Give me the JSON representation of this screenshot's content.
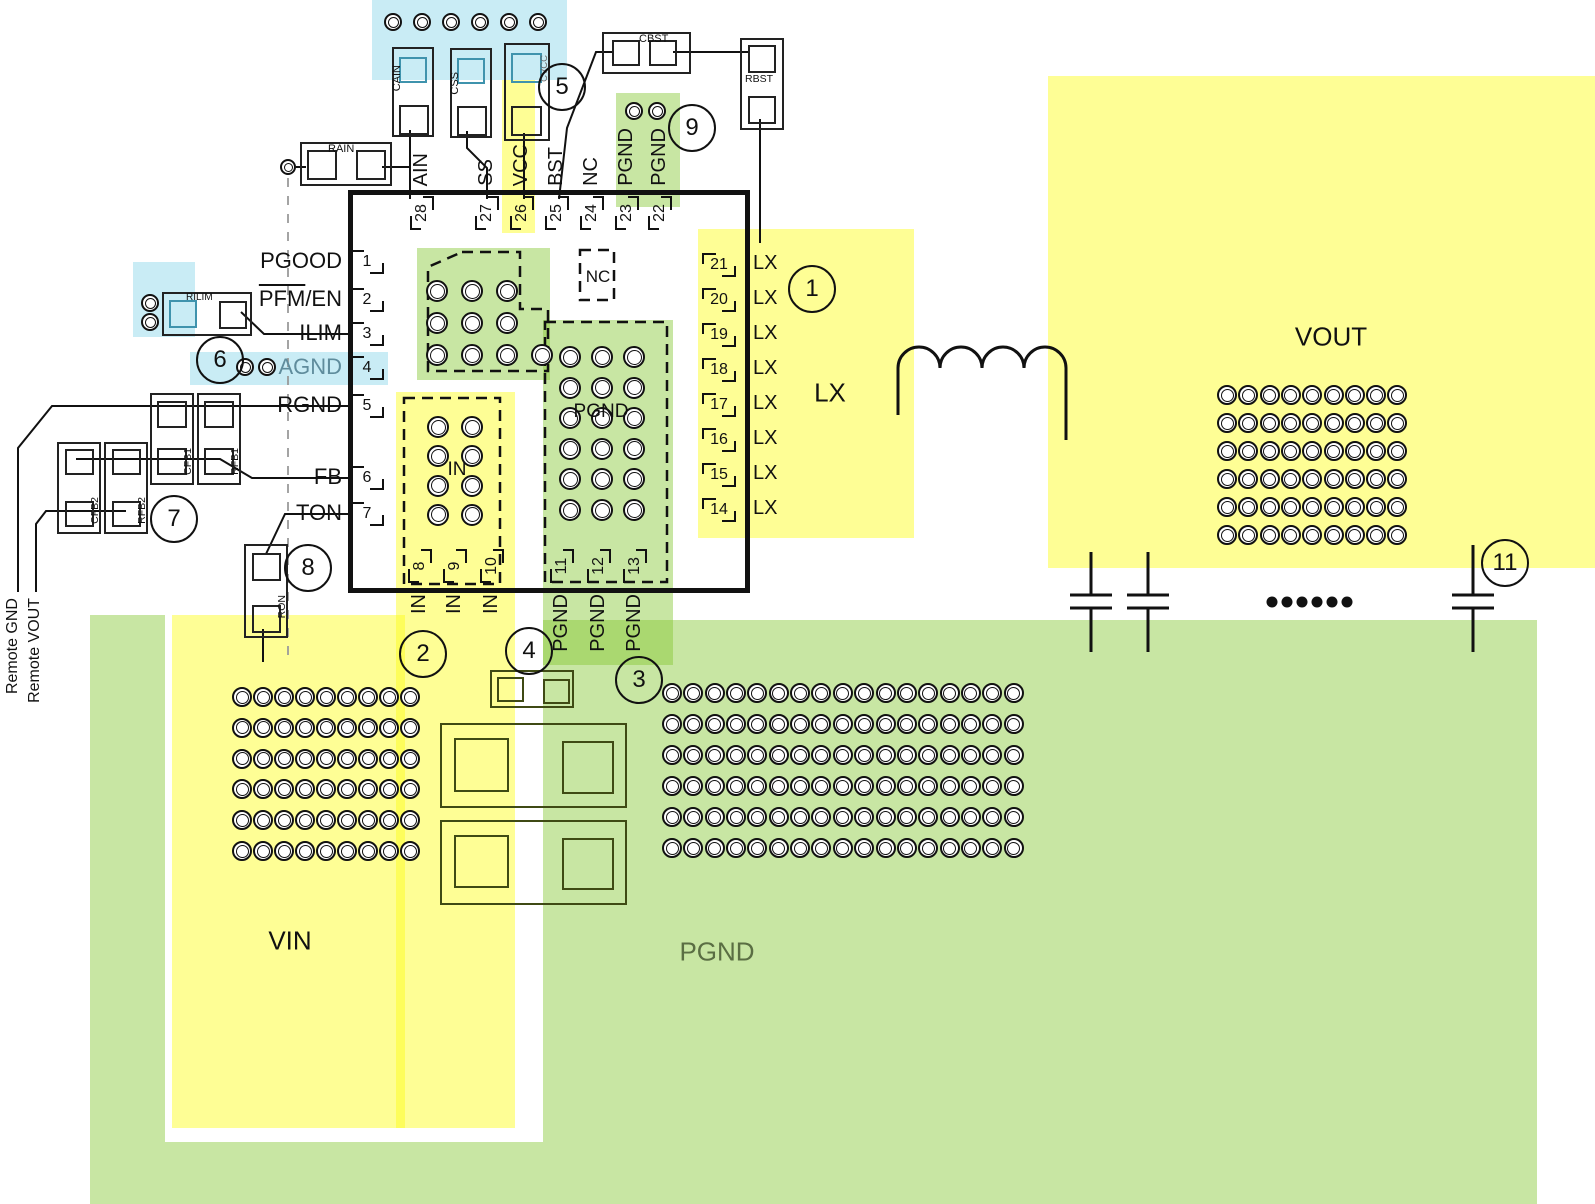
{
  "regions": {
    "vin": "VIN",
    "pgnd_plane": "PGND",
    "vout": "VOUT",
    "lx_area": "LX",
    "in_inner": "IN",
    "pgnd_inner": "PGND",
    "nc_inner": "NC"
  },
  "ic": {
    "pins_left": [
      {
        "num": "1",
        "label": "PGOOD"
      },
      {
        "num": "2",
        "label": "PFM/EN",
        "overline": "PFM"
      },
      {
        "num": "3",
        "label": "ILIM"
      },
      {
        "num": "4",
        "label": "AGND"
      },
      {
        "num": "5",
        "label": "RGND"
      },
      {
        "num": "6",
        "label": "FB"
      },
      {
        "num": "7",
        "label": "TON"
      }
    ],
    "pins_top": [
      {
        "num": "28",
        "label": "AIN"
      },
      {
        "num": "27",
        "label": "SS"
      },
      {
        "num": "26",
        "label": "VCC"
      },
      {
        "num": "25",
        "label": "BST"
      },
      {
        "num": "24",
        "label": "NC"
      },
      {
        "num": "23",
        "label": "PGND"
      },
      {
        "num": "22",
        "label": "PGND"
      }
    ],
    "pins_right": [
      {
        "num": "21",
        "label": "LX"
      },
      {
        "num": "20",
        "label": "LX"
      },
      {
        "num": "19",
        "label": "LX"
      },
      {
        "num": "18",
        "label": "LX"
      },
      {
        "num": "17",
        "label": "LX"
      },
      {
        "num": "16",
        "label": "LX"
      },
      {
        "num": "15",
        "label": "LX"
      },
      {
        "num": "14",
        "label": "LX"
      }
    ],
    "pins_bottom": [
      {
        "num": "8",
        "label": "IN"
      },
      {
        "num": "9",
        "label": "IN"
      },
      {
        "num": "10",
        "label": "IN"
      },
      {
        "num": "11",
        "label": "PGND"
      },
      {
        "num": "12",
        "label": "PGND"
      },
      {
        "num": "13",
        "label": "PGND"
      }
    ]
  },
  "components": {
    "cain": "CAIN",
    "css": "CSS",
    "cvcc": "CVCC",
    "cbst": "CBST",
    "rbst": "RBST",
    "rain": "RAIN",
    "rilim": "RILIM",
    "cfb1": "CFB1",
    "rfb1": "RFB1",
    "cfb2": "CFB2",
    "rfb2": "RFB2",
    "ron": "RON"
  },
  "remote": {
    "gnd": "Remote GND",
    "vout": "Remote VOUT"
  },
  "callouts": [
    "1",
    "2",
    "3",
    "4",
    "5",
    "6",
    "7",
    "8",
    "9",
    "11"
  ],
  "colors": {
    "copper_yellow": "#feff8d",
    "ground_green": "#c7e6a4",
    "highlight_blue": "#c9ecf5",
    "pad_teal": "#3f93ad",
    "agnd_text": "#5f8c9c",
    "pgnd_label_green": "#5a6e43"
  }
}
